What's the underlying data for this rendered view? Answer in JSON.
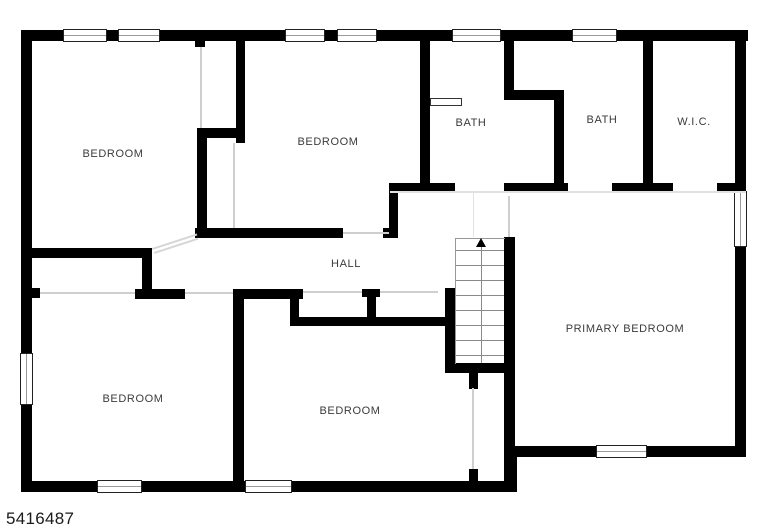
{
  "floorplan": {
    "id_number": "5416487",
    "rooms": [
      {
        "key": "bedroom-top-left",
        "label": "BEDROOM"
      },
      {
        "key": "bedroom-top-middle",
        "label": "BEDROOM"
      },
      {
        "key": "bath-left",
        "label": "BATH"
      },
      {
        "key": "bath-right",
        "label": "BATH"
      },
      {
        "key": "walk-in-closet",
        "label": "W.I.C."
      },
      {
        "key": "hall",
        "label": "HALL"
      },
      {
        "key": "primary-bedroom",
        "label": "PRIMARY BEDROOM"
      },
      {
        "key": "bedroom-bottom-left",
        "label": "BEDROOM"
      },
      {
        "key": "bedroom-bottom-middle",
        "label": "BEDROOM"
      }
    ],
    "stairs": {
      "arrow_direction": "up"
    },
    "colors": {
      "wall": "#000000",
      "background": "#ffffff",
      "label_text": "#3b3b3b",
      "door_line": "#cfcfcf",
      "stair_line": "#8a8a8a"
    }
  }
}
